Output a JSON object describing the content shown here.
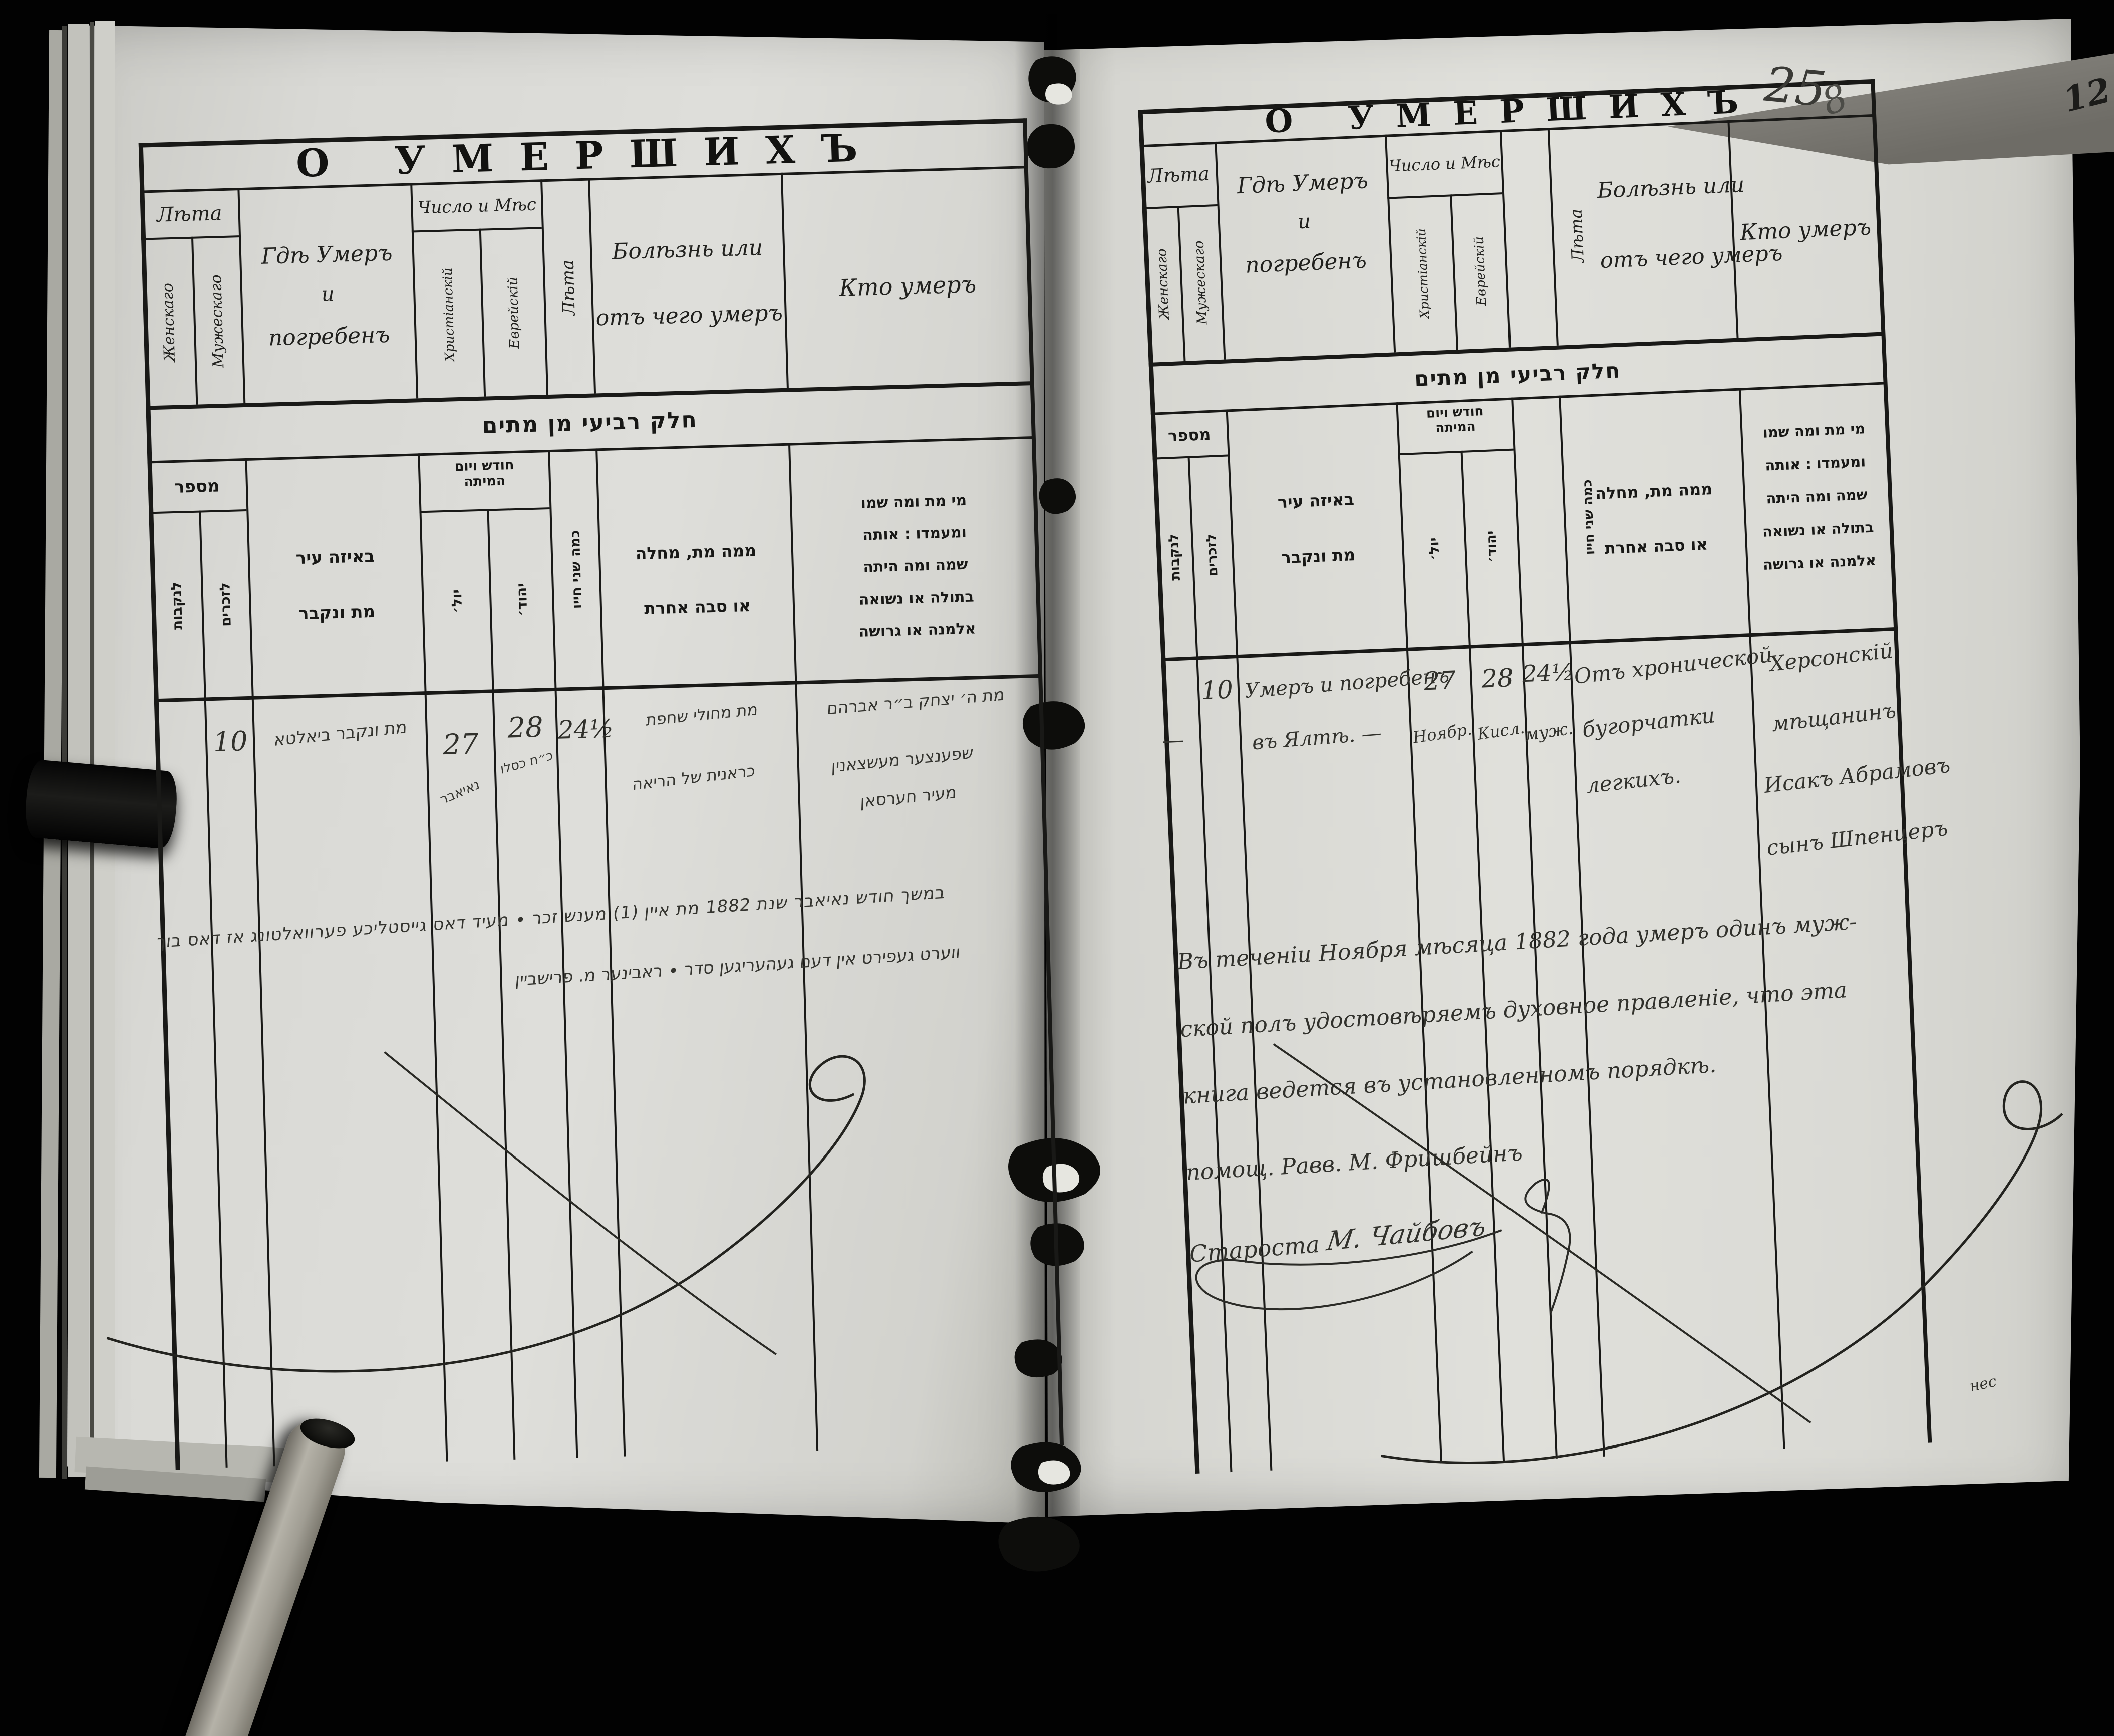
{
  "form": {
    "title": "О УМЕРШИХЪ",
    "age_group": "Лѣта",
    "age_female": "Женскаго",
    "age_male": "Мужескаго",
    "where_l1": "Гдѣ Умеръ",
    "where_l2": "и",
    "where_l3": "погребенъ",
    "date_group": "Число и Мѣс",
    "date_christian": "Христіанскій",
    "date_jewish": "Еврейскій",
    "years": "Лѣта",
    "illness_l1": "Болѣзнь или",
    "illness_l2": "отъ чего умеръ",
    "who": "Кто умеръ",
    "heb_banner": "חלק רביעי מן מתים",
    "heb_number": "מספר",
    "heb_number_female": "לנקבות",
    "heb_number_male": "לזכרים",
    "heb_where_l1": "באיזה עיר",
    "heb_where_l2": "מת ונקבר",
    "heb_date_l1": "חודש ויום",
    "heb_date_l2": "המיתה",
    "heb_date_julian": "יול׳",
    "heb_date_jewish": "יהוד׳",
    "heb_years": "כמה שני חייו",
    "heb_illness_l1": "ממה מת, מחלה",
    "heb_illness_l2": "או סבה אחרת",
    "heb_who_l1": "מי מת ומה שמו",
    "heb_who_l2": "ומעמדו : אותה",
    "heb_who_l3": "שמה ומה היתה",
    "heb_who_l4": "בתולה או נשואה",
    "heb_who_l5": "אלמנה או גרושה"
  },
  "left_page": {
    "record": {
      "male_number": "10",
      "where": "מת ונקבר ביאלטא",
      "date_julian_day": "27",
      "date_julian_month": "נאיאבר",
      "date_jewish_day": "28",
      "date_jewish_month": "כ״ח כסלו",
      "age": "24½",
      "illness_l1": "מת מחולי שחפת",
      "illness_l2": "כראנית של הריאה",
      "who_l1": "מת ה׳ יצחק ב״ר אברהם",
      "who_l2": "שפענצער מעשצאנין",
      "who_l3": "מעיר חערסאן"
    },
    "note_l1": "במשך חודש נאיאבר שנת 1882 מת איין (1) מענש זכר ∙ מעיד דאס גייסטליכע פערוואלטונג אז דאס בוך",
    "note_l2": "ווערט געפירט אין דעם געהעריגען סדר ∙ ראבינער מ. פרישביין"
  },
  "right_page": {
    "page_number": "25",
    "page_number_extra": "8",
    "record": {
      "female_mark": "—",
      "male_number": "10",
      "where_l1": "Умеръ и погребенъ",
      "where_l2": "въ Ялтѣ. —",
      "date_julian_day": "27",
      "date_julian_month": "Ноябр.",
      "date_jewish_day": "28",
      "date_jewish_month": "Кисл.",
      "age": "24½",
      "age_note": "муж.",
      "illness_l1": "Отъ хронической",
      "illness_l2": "бугорчатки",
      "illness_l3": "легкихъ.",
      "who_l1": "Херсонскій",
      "who_l2": "мѣщанинъ",
      "who_l3": "Исакъ Абрамовъ",
      "who_l4": "сынъ Шпенцеръ"
    },
    "note_l1": "Въ теченіи Ноября мѣсяца 1882 года умеръ одинъ муж-",
    "note_l2": "ской полъ удостовѣряемъ духовное правленіе, что эта",
    "note_l3": "книга ведется въ установленномъ порядкѣ.",
    "note_l4": "помощ. Равв. М. Фришбейнъ",
    "signature_title": "Староста",
    "signature_name": "М. Чайбовъ",
    "corner_mark": "нес"
  },
  "artifacts": {
    "prev_page_mark": "12"
  }
}
